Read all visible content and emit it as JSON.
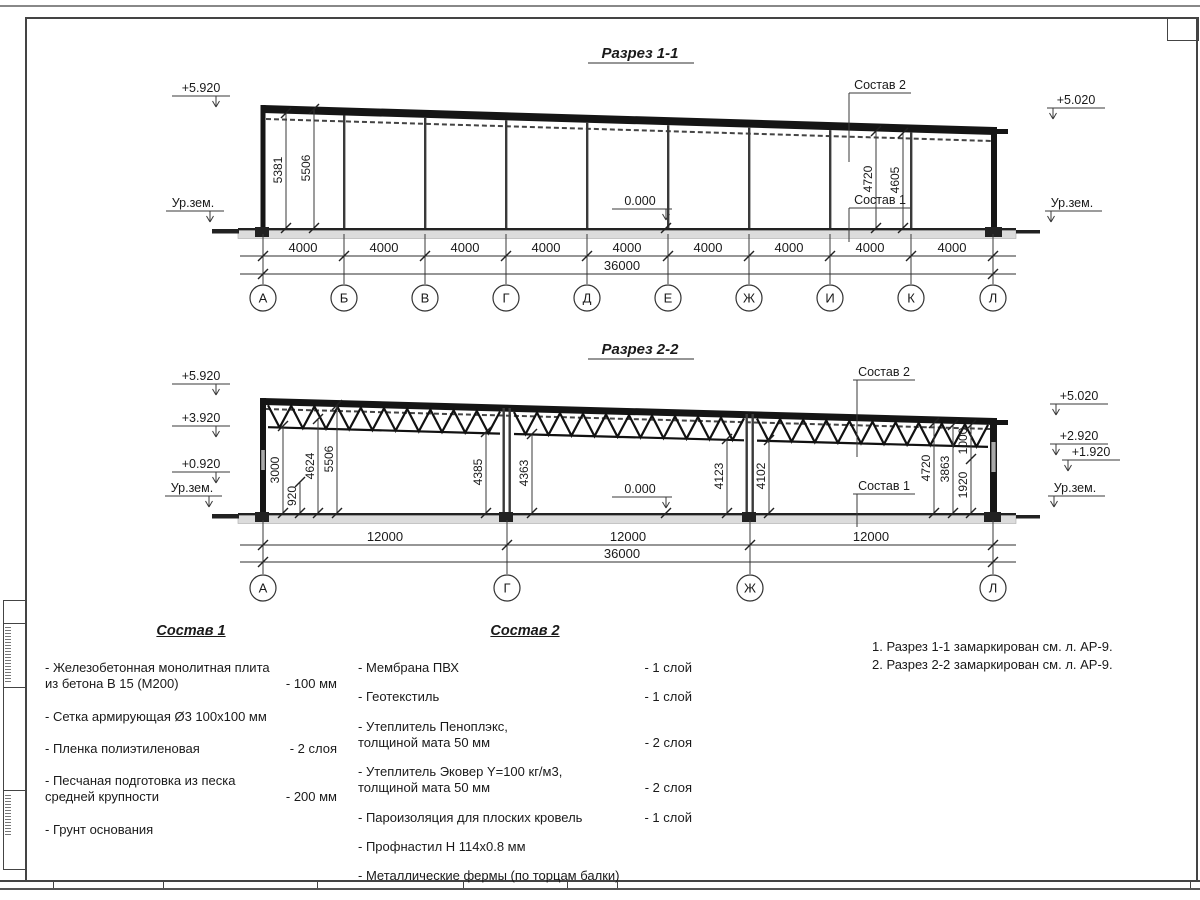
{
  "section1": {
    "title": "Разрез 1-1",
    "elev_left_top": "+5.920",
    "ground_left": "Ур.зем.",
    "elev_right_top": "+5.020",
    "ground_right": "Ур.зем.",
    "zero": "0.000",
    "layers1_label": "Состав 1",
    "layers2_label": "Состав 2",
    "height_dims": [
      "5381",
      "5506",
      "4720",
      "4605"
    ],
    "bay_dims": [
      "4000",
      "4000",
      "4000",
      "4000",
      "4000",
      "4000",
      "4000",
      "4000",
      "4000"
    ],
    "total_dim": "36000",
    "grid_labels": [
      "А",
      "Б",
      "В",
      "Г",
      "Д",
      "Е",
      "Ж",
      "И",
      "К",
      "Л"
    ]
  },
  "section2": {
    "title": "Разрез 2-2",
    "elev_left": [
      "+5.920",
      "+3.920",
      "+0.920"
    ],
    "ground_left": "Ур.зем.",
    "elev_right": [
      "+5.020",
      "+2.920",
      "+1.920"
    ],
    "ground_right": "Ур.зем.",
    "zero": "0.000",
    "layers1_label": "Состав 1",
    "layers2_label": "Состав 2",
    "dims_left": [
      "3000",
      "920",
      "4624",
      "5506"
    ],
    "dims_mid": [
      "4385",
      "4363",
      "4123",
      "4102"
    ],
    "dims_right": [
      "4720",
      "3863",
      "1000",
      "1920"
    ],
    "bay_dims": [
      "12000",
      "12000",
      "12000"
    ],
    "total_dim": "36000",
    "grid_labels": [
      "А",
      "Г",
      "Ж",
      "Л"
    ]
  },
  "layers1": {
    "heading": "Состав 1",
    "items": [
      {
        "name": "- Железобетонная  монолитная плита\nиз бетона В 15 (М200)",
        "qty": "- 100 мм"
      },
      {
        "name": "- Сетка армирующая Ø3 100х100 мм",
        "qty": ""
      },
      {
        "name": "- Пленка полиэтиленовая",
        "qty": "-  2 слоя"
      },
      {
        "name": "- Песчаная подготовка из песка\nсредней крупности",
        "qty": "- 200 мм"
      },
      {
        "name": "- Грунт основания",
        "qty": ""
      }
    ]
  },
  "layers2": {
    "heading": "Состав 2",
    "items": [
      {
        "name": "- Мембрана ПВХ",
        "qty": "- 1 слой"
      },
      {
        "name": "- Геотекстиль",
        "qty": "- 1 слой"
      },
      {
        "name": "- Утеплитель Пеноплэкс,\nтолщиной мата 50 мм",
        "qty": "- 2 слоя"
      },
      {
        "name": "- Утеплитель Эковер Y=100 кг/м3,\nтолщиной мата 50 мм",
        "qty": "- 2 слоя"
      },
      {
        "name": "- Пароизоляция для плоских кровель",
        "qty": "- 1 слой"
      },
      {
        "name": "- Профнастил Н 114х0.8 мм",
        "qty": ""
      },
      {
        "name": "- Металлические фермы (по торцам балки)",
        "qty": ""
      }
    ]
  },
  "notes": {
    "line1": "1. Разрез 1-1 замаркирован см. л. АР-9.",
    "line2": "2. Разрез 2-2 замаркирован см. л. АР-9."
  }
}
